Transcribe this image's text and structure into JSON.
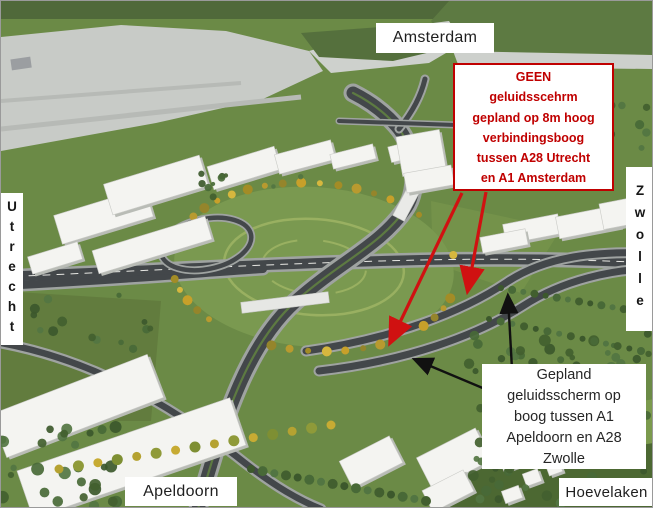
{
  "direction_labels": {
    "top": "Amsterdam",
    "left": "Utrecht",
    "right": "Zwolle",
    "bottom_left": "Apeldoorn",
    "bottom_right": "Hoevelaken"
  },
  "annotations": {
    "no_screen": {
      "text": "GEEN\ngeluidsscehrm\ngepland op 8m hoog\nverbindingsboog\ntussen A28 Utrecht\nen A1 Amsterdam",
      "text_color": "#c00000",
      "border_color": "#c00000",
      "arrow_color": "#d01111",
      "arrow_count": 2
    },
    "planned_screen": {
      "text": "Gepland\ngeluidsscherm op\nboog tussen A1\nApeldoorn en A28\nZwolle",
      "text_color": "#262626",
      "arrow_color": "#111111",
      "arrow_count": 2
    }
  },
  "scene_colors": {
    "grass": "#6b8a46",
    "paved_area": "#c8cbc7",
    "road_asphalt": "#43474a",
    "autumn_trees": "#c7a02a",
    "dark_trees": "#3c582c",
    "label_background": "#ffffff"
  }
}
